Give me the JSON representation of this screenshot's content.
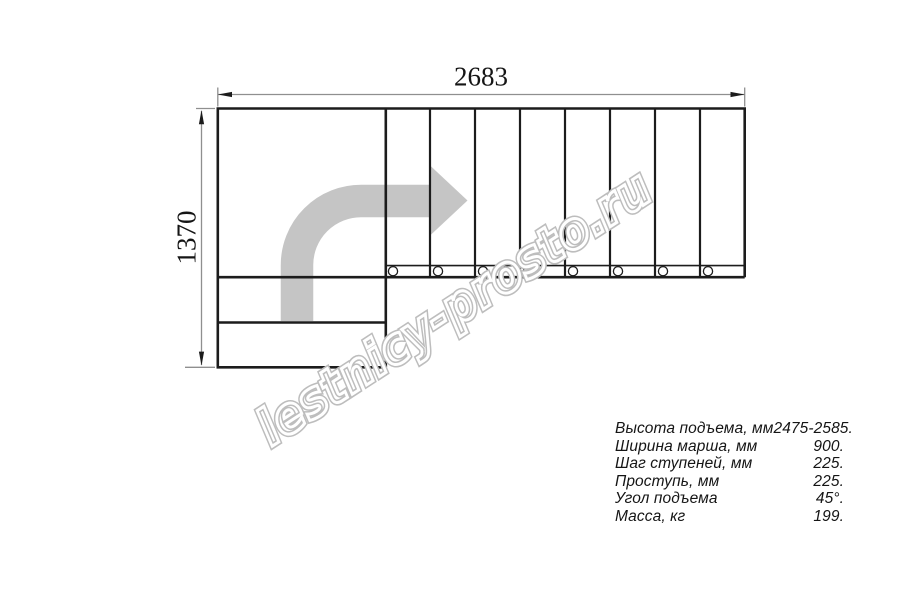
{
  "drawing": {
    "type": "staircase-plan-top-view",
    "dimension_width_mm": "2683",
    "dimension_height_mm": "1370",
    "flight_steps": 8,
    "bottom_steps": 2,
    "landing": true,
    "direction": "up-then-right"
  },
  "watermark": {
    "text": "lestnicy-prosto.ru"
  },
  "specs": {
    "rows": [
      {
        "label": "Высота подъема, мм",
        "value": "2475-2585."
      },
      {
        "label": "Ширина марша, мм",
        "value": "900."
      },
      {
        "label": "Шаг ступеней, мм",
        "value": "225."
      },
      {
        "label": "Проступь, мм",
        "value": "225."
      },
      {
        "label": "Угол подъема",
        "value": "45°."
      },
      {
        "label": "Масса, кг",
        "value": "199."
      }
    ]
  },
  "colors": {
    "line": "#1c1c1c",
    "dimension": "#8f8f8f",
    "arrow": "#c5c5c5",
    "watermark": "#bdbdbd",
    "bg": "#ffffff"
  }
}
